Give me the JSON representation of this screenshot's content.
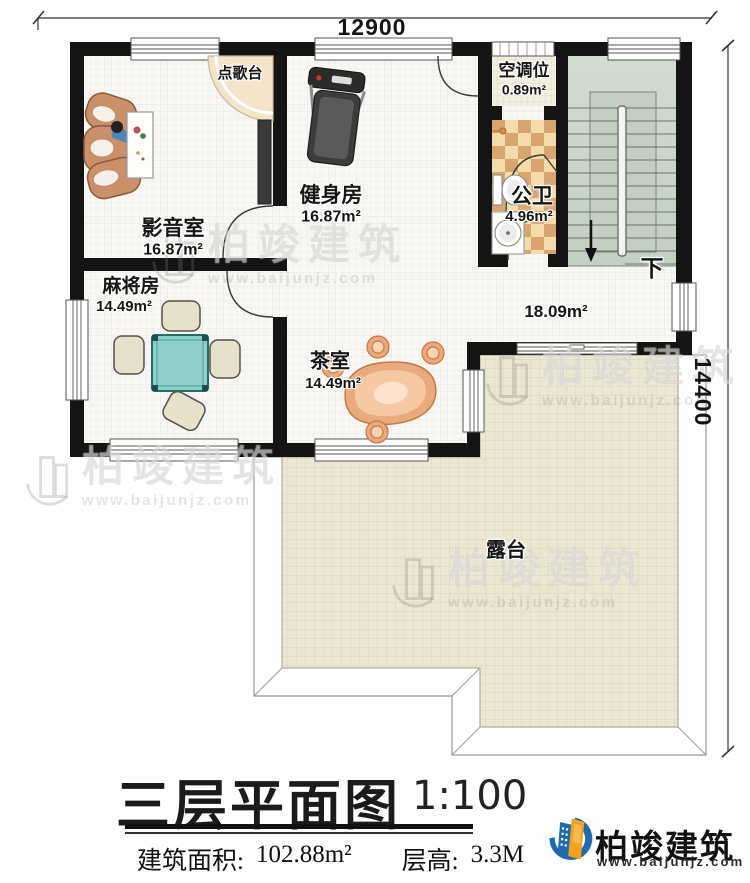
{
  "dimensions": {
    "width_mm": "12900",
    "height_mm": "14400"
  },
  "rooms": {
    "karaoke": {
      "label": "点歌台"
    },
    "media": {
      "label": "影音室",
      "area": "16.87m²"
    },
    "gym": {
      "label": "健身房",
      "area": "16.87m²"
    },
    "ac": {
      "label": "空调位",
      "area": "0.89m²"
    },
    "bath": {
      "label": "公卫",
      "area": "4.96m²"
    },
    "mahjong": {
      "label": "麻将房",
      "area": "14.49m²"
    },
    "tea": {
      "label": "茶室",
      "area": "14.49m²"
    },
    "hall": {
      "area": "18.09m²"
    },
    "terrace": {
      "label": "露台"
    }
  },
  "stairs": {
    "down": "下"
  },
  "title_block": {
    "title": "三层平面图",
    "scale": "1:100",
    "area_label": "建筑面积:",
    "area_value": "102.88m²",
    "floor_height_label": "层高:",
    "floor_height_value": "3.3M"
  },
  "brand": {
    "name": "柏竣建筑",
    "website": "www.baijunjz.com"
  },
  "watermark": {
    "name": "柏竣建筑",
    "website": "www.baijunjz.com"
  },
  "colors": {
    "wall": "#141414",
    "terrace_tile": "#ebe7d2",
    "stair_green": "#ccd7cb",
    "bath_tile_dark": "#d7a570",
    "bath_tile_light": "#f3dcaa",
    "table_teal": "#8ed0c9",
    "brand_blue": "#1b6cb3",
    "brand_orange": "#f7a11a"
  }
}
